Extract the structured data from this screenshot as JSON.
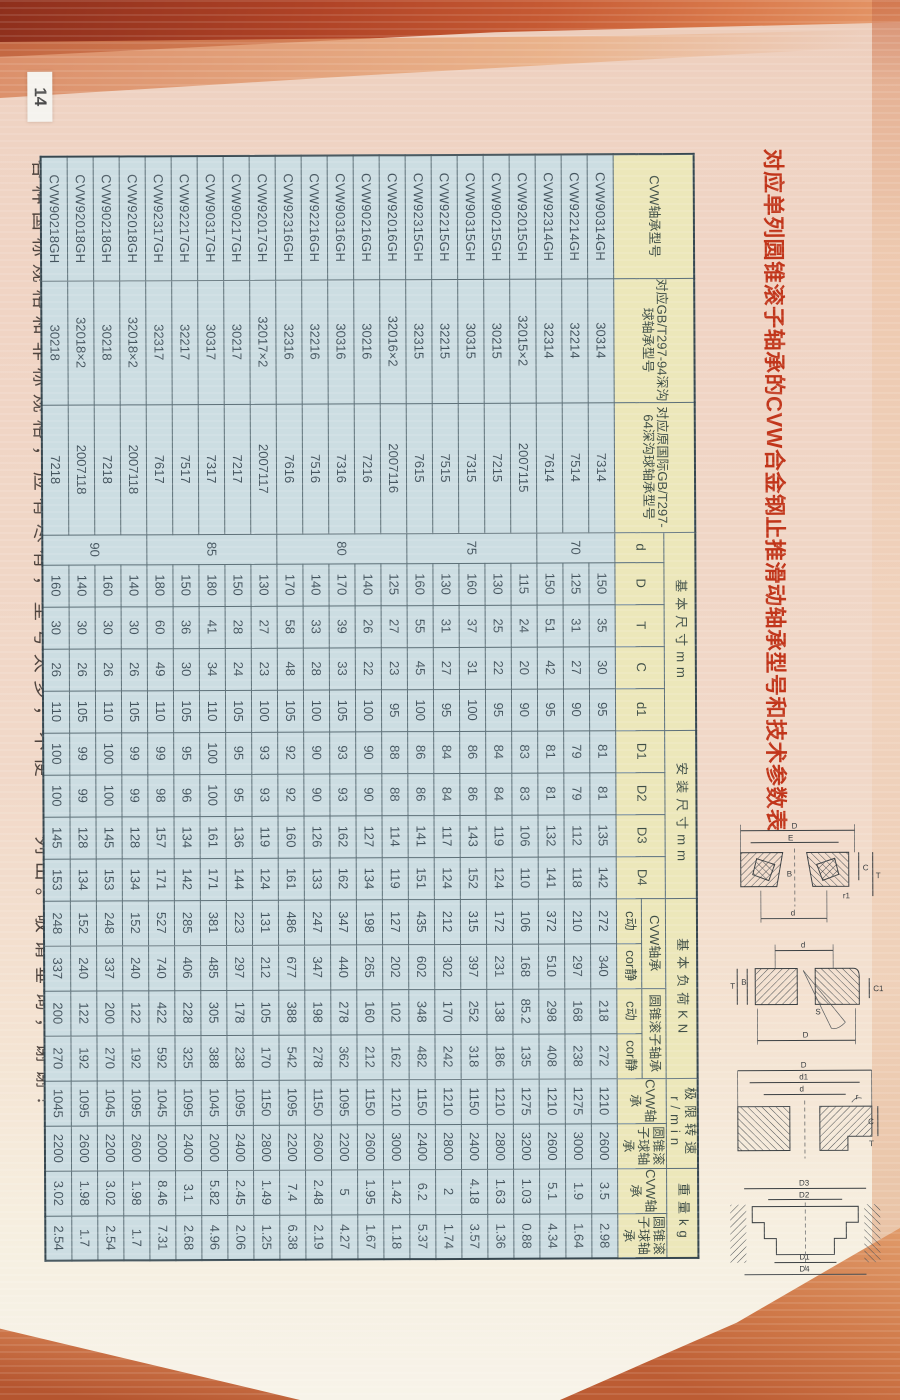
{
  "page": {
    "page_number": "14",
    "title": "对应单列圆锥滚子轴承的CVW合金钢止推滑动轴承型号和技术参数表",
    "footer_note": "各种国标规格和非标规格，应有尽有，型号太多，不便一一列出。敬请垂询，谢谢！",
    "colors": {
      "title_red": "#c1351a",
      "header_yellow": "#ece7ba",
      "cell_blue": "#ccdde2",
      "page_pink": "#f0d5c5",
      "deco_orange": "#cb7347"
    }
  },
  "table": {
    "headers": {
      "model": "CVW轴承型号",
      "gb_new": "对应GB/T297-94深沟球轴承型号",
      "gb_old": "对应原国际GB/T297-64深沟球轴承型号",
      "basic_dims": "基本尺寸mm",
      "basic_dims_subs": [
        "d",
        "D",
        "T",
        "C",
        "d1"
      ],
      "mount_dims": "安装尺寸mm",
      "mount_dims_subs": [
        "D1",
        "D2",
        "D3",
        "D4"
      ],
      "load": "基本负荷KN",
      "load_cvw": "CVW轴承",
      "load_taper": "圆锥滚子轴承",
      "load_subs": [
        "c动",
        "cor静"
      ],
      "speed": "极限转速r/min",
      "speed_subs": [
        "CVW轴承",
        "圆锥滚子球轴承"
      ],
      "weight": "重量kg",
      "weight_subs": [
        "CVW轴承",
        "圆锥滚子球轴承"
      ]
    },
    "d_groups": [
      {
        "d": "70",
        "span": 3
      },
      {
        "d": "75",
        "span": 5
      },
      {
        "d": "80",
        "span": 5
      },
      {
        "d": "85",
        "span": 5
      },
      {
        "d": "90",
        "span": 4
      }
    ],
    "rows": [
      [
        "CVW90314GH",
        "30314",
        "7314",
        "150",
        "35",
        "30",
        "95",
        "81",
        "81",
        "135",
        "142",
        "272",
        "340",
        "218",
        "272",
        "1210",
        "2600",
        "3.5",
        "2.98"
      ],
      [
        "CVW92214GH",
        "32214",
        "7514",
        "125",
        "31",
        "27",
        "90",
        "79",
        "79",
        "112",
        "118",
        "210",
        "297",
        "168",
        "238",
        "1275",
        "3000",
        "1.9",
        "1.64"
      ],
      [
        "CVW92314GH",
        "32314",
        "7614",
        "150",
        "51",
        "42",
        "95",
        "81",
        "81",
        "132",
        "141",
        "372",
        "510",
        "298",
        "408",
        "1210",
        "2600",
        "5.1",
        "4.34"
      ],
      [
        "CVW92015GH",
        "32015×2",
        "2007115",
        "115",
        "24",
        "20",
        "90",
        "83",
        "83",
        "106",
        "110",
        "106",
        "168",
        "85.2",
        "135",
        "1275",
        "3200",
        "1.03",
        "0.88"
      ],
      [
        "CVW90215GH",
        "30215",
        "7215",
        "130",
        "25",
        "22",
        "95",
        "84",
        "84",
        "119",
        "124",
        "172",
        "231",
        "138",
        "186",
        "1210",
        "2800",
        "1.63",
        "1.36"
      ],
      [
        "CVW90315GH",
        "30315",
        "7315",
        "160",
        "37",
        "31",
        "100",
        "86",
        "86",
        "143",
        "152",
        "315",
        "397",
        "252",
        "318",
        "1150",
        "2400",
        "4.18",
        "3.57"
      ],
      [
        "CVW92215GH",
        "32215",
        "7515",
        "130",
        "31",
        "27",
        "95",
        "84",
        "84",
        "117",
        "124",
        "212",
        "302",
        "170",
        "242",
        "1210",
        "2800",
        "2",
        "1.74"
      ],
      [
        "CVW92315GH",
        "32315",
        "7615",
        "160",
        "55",
        "45",
        "100",
        "86",
        "86",
        "141",
        "151",
        "435",
        "602",
        "348",
        "482",
        "1150",
        "2400",
        "6.2",
        "5.37"
      ],
      [
        "CVW92016GH",
        "32016×2",
        "2007116",
        "125",
        "27",
        "23",
        "95",
        "88",
        "88",
        "114",
        "119",
        "127",
        "202",
        "102",
        "162",
        "1210",
        "3000",
        "1.42",
        "1.18"
      ],
      [
        "CVW90216GH",
        "30216",
        "7216",
        "140",
        "26",
        "22",
        "100",
        "90",
        "90",
        "127",
        "134",
        "198",
        "265",
        "160",
        "212",
        "1150",
        "2600",
        "1.95",
        "1.67"
      ],
      [
        "CVW90316GH",
        "30316",
        "7316",
        "170",
        "39",
        "33",
        "105",
        "93",
        "93",
        "162",
        "162",
        "347",
        "440",
        "278",
        "362",
        "1095",
        "2200",
        "5",
        "4.27"
      ],
      [
        "CVW92216GH",
        "32216",
        "7516",
        "140",
        "33",
        "28",
        "100",
        "90",
        "90",
        "126",
        "133",
        "247",
        "347",
        "198",
        "278",
        "1150",
        "2600",
        "2.48",
        "2.19"
      ],
      [
        "CVW92316GH",
        "32316",
        "7616",
        "170",
        "58",
        "48",
        "105",
        "92",
        "92",
        "160",
        "161",
        "486",
        "677",
        "388",
        "542",
        "1095",
        "2200",
        "7.4",
        "6.38"
      ],
      [
        "CVW92017GH",
        "32017×2",
        "2007117",
        "130",
        "27",
        "23",
        "100",
        "93",
        "93",
        "119",
        "124",
        "131",
        "212",
        "105",
        "170",
        "1150",
        "2800",
        "1.49",
        "1.25"
      ],
      [
        "CVW90217GH",
        "30217",
        "7217",
        "150",
        "28",
        "24",
        "105",
        "95",
        "95",
        "136",
        "144",
        "223",
        "297",
        "178",
        "238",
        "1095",
        "2400",
        "2.45",
        "2.06"
      ],
      [
        "CVW90317GH",
        "30317",
        "7317",
        "180",
        "41",
        "34",
        "110",
        "100",
        "100",
        "161",
        "171",
        "381",
        "485",
        "305",
        "388",
        "1045",
        "2000",
        "5.82",
        "4.96"
      ],
      [
        "CVW92217GH",
        "32217",
        "7517",
        "150",
        "36",
        "30",
        "105",
        "95",
        "96",
        "134",
        "142",
        "285",
        "406",
        "228",
        "325",
        "1095",
        "2400",
        "3.1",
        "2.68"
      ],
      [
        "CVW92317GH",
        "32317",
        "7617",
        "180",
        "60",
        "49",
        "110",
        "99",
        "98",
        "157",
        "171",
        "527",
        "740",
        "422",
        "592",
        "1045",
        "2000",
        "8.46",
        "7.31"
      ],
      [
        "CVW92018GH",
        "32018×2",
        "2007118",
        "140",
        "30",
        "26",
        "105",
        "99",
        "99",
        "128",
        "134",
        "152",
        "240",
        "122",
        "192",
        "1095",
        "2600",
        "1.98",
        "1.7"
      ],
      [
        "CVW90218GH",
        "30218",
        "7218",
        "160",
        "30",
        "26",
        "110",
        "100",
        "100",
        "145",
        "153",
        "248",
        "337",
        "200",
        "270",
        "1045",
        "2200",
        "3.02",
        "2.54"
      ],
      [
        "CVW92018GH",
        "32018×2",
        "2007118",
        "140",
        "30",
        "26",
        "105",
        "99",
        "99",
        "128",
        "134",
        "152",
        "240",
        "122",
        "192",
        "1095",
        "2600",
        "1.98",
        "1.7"
      ],
      [
        "CVW90218GH",
        "30218",
        "7218",
        "160",
        "30",
        "26",
        "110",
        "100",
        "100",
        "145",
        "153",
        "248",
        "337",
        "200",
        "270",
        "1045",
        "2200",
        "3.02",
        "2.54"
      ]
    ]
  },
  "diagrams": {
    "taper": [
      "D",
      "E",
      "B",
      "r1",
      "C",
      "T",
      "d"
    ],
    "align": [
      "d",
      "T",
      "B",
      "S",
      "D",
      "C1"
    ],
    "washer": [
      "D",
      "d1",
      "d",
      "r",
      "C",
      "T"
    ],
    "mount": [
      "D3",
      "D2",
      "D1",
      "D4"
    ]
  }
}
